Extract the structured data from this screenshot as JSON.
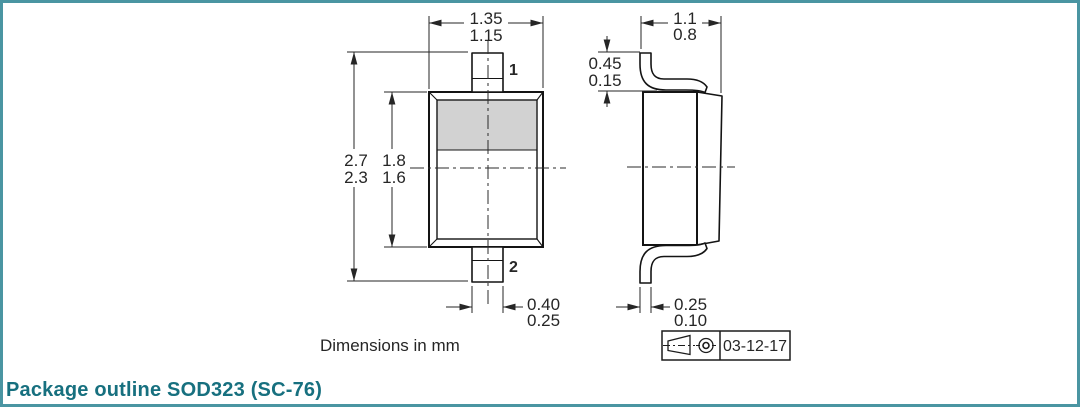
{
  "colors": {
    "accent_teal_text": "#17707f",
    "frame_teal": "#4a95a2",
    "drawing_line": "#141414",
    "cathode_band_gray": "#d2d2d2"
  },
  "caption": {
    "note": "Dimensions in mm",
    "title": "Package outline SOD323 (SC-76)"
  },
  "front_view": {
    "pin1": "1",
    "pin2": "2",
    "dims": {
      "body_width": {
        "max": "1.35",
        "min": "1.15"
      },
      "overall_height": {
        "max": "2.7",
        "min": "2.3"
      },
      "body_height": {
        "max": "1.8",
        "min": "1.6"
      },
      "lead_width": {
        "max": "0.40",
        "min": "0.25"
      }
    }
  },
  "side_view": {
    "dims": {
      "overall_width": {
        "max": "1.1",
        "min": "0.8"
      },
      "lead_height": {
        "max": "0.45",
        "min": "0.15"
      },
      "lead_thickness": {
        "max": "0.25",
        "min": "0.10"
      }
    }
  },
  "title_block": {
    "projection_icon": "first-angle-projection",
    "date": "03-12-17"
  }
}
